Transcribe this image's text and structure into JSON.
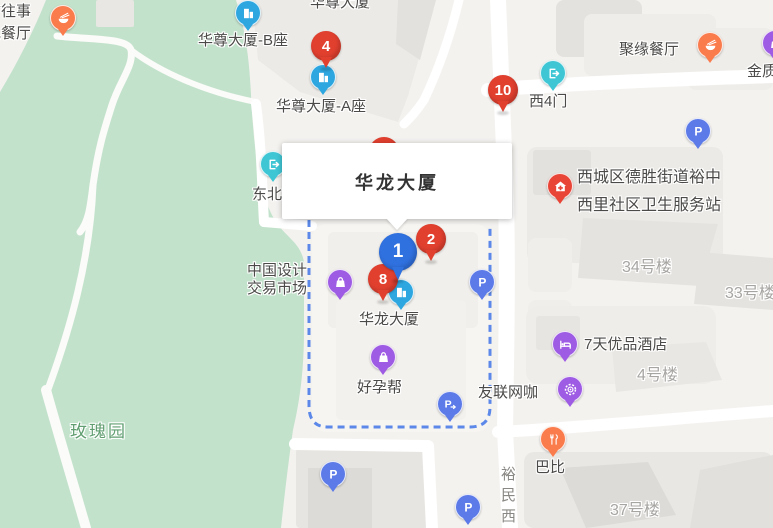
{
  "popup": {
    "title": "华龙大厦"
  },
  "colors": {
    "marker_red": "#e2402f",
    "marker_blue": "#3071e0",
    "poi_blue": "#2ea7e0",
    "poi_cyan": "#3fc6d5",
    "poi_purple": "#9e5be4",
    "poi_orange": "#fa7b4c",
    "poi_red": "#e84537",
    "parking_blue": "#5c7be8",
    "boundary_blue": "#4a7ce8",
    "park_green": "#c3e2cc",
    "label_dark": "#4b4a48",
    "label_gray": "#a7a5a2",
    "label_green": "#609e71"
  },
  "map": {
    "labels": [
      {
        "id": "guwangshi-restaurant",
        "lines": [
          "古往事",
          "色餐厅"
        ],
        "x": -14,
        "y": 1,
        "kind": "dark",
        "lh": 22
      },
      {
        "id": "huazun-tower",
        "lines": [
          "华尊大厦"
        ],
        "x": 310,
        "y": -7,
        "kind": "dark"
      },
      {
        "id": "huazun-tower-b",
        "lines": [
          "华尊大厦-B座"
        ],
        "x": 198,
        "y": 31,
        "kind": "dark"
      },
      {
        "id": "huazun-tower-a",
        "lines": [
          "华尊大厦-A座"
        ],
        "x": 276,
        "y": 97,
        "kind": "dark"
      },
      {
        "id": "juyuan-restaurant",
        "lines": [
          "聚缘餐厅"
        ],
        "x": 619,
        "y": 40,
        "kind": "dark"
      },
      {
        "id": "jinzhi",
        "lines": [
          "金质"
        ],
        "x": 747,
        "y": 62,
        "kind": "dark"
      },
      {
        "id": "west-gate-4",
        "lines": [
          "西4门"
        ],
        "x": 529,
        "y": 92,
        "kind": "dark"
      },
      {
        "id": "northeast-gate",
        "lines": [
          "东北门"
        ],
        "x": 252,
        "y": 185,
        "kind": "dark"
      },
      {
        "id": "health-service-station",
        "lines": [
          "西城区德胜街道裕中",
          "西里社区卫生服务站"
        ],
        "x": 577,
        "y": 164,
        "kind": "dark",
        "size": 16,
        "lh": 28
      },
      {
        "id": "building-34",
        "lines": [
          "34号楼"
        ],
        "x": 622,
        "y": 258,
        "kind": "area"
      },
      {
        "id": "building-33",
        "lines": [
          "33号楼"
        ],
        "x": 725,
        "y": 284,
        "kind": "area"
      },
      {
        "id": "china-design-market",
        "lines": [
          "中国设计",
          "交易市场"
        ],
        "x": 247,
        "y": 262,
        "kind": "dark",
        "lh": 18
      },
      {
        "id": "hualong-building",
        "lines": [
          "华龙大厦"
        ],
        "x": 359,
        "y": 310,
        "kind": "dark"
      },
      {
        "id": "haoyunbang",
        "lines": [
          "好孕帮"
        ],
        "x": 357,
        "y": 378,
        "kind": "dark"
      },
      {
        "id": "7days-hotel",
        "lines": [
          "7天优品酒店"
        ],
        "x": 584,
        "y": 335,
        "kind": "dark"
      },
      {
        "id": "building-4",
        "lines": [
          "4号楼"
        ],
        "x": 637,
        "y": 366,
        "kind": "area"
      },
      {
        "id": "youlian-netcafe",
        "lines": [
          "友联网咖"
        ],
        "x": 478,
        "y": 383,
        "kind": "dark"
      },
      {
        "id": "babi",
        "lines": [
          "巴比"
        ],
        "x": 535,
        "y": 458,
        "kind": "dark"
      },
      {
        "id": "building-37",
        "lines": [
          "37号楼"
        ],
        "x": 610,
        "y": 501,
        "kind": "area"
      },
      {
        "id": "rose-garden",
        "lines": [
          "玫瑰园"
        ],
        "x": 70,
        "y": 422,
        "kind": "park"
      },
      {
        "id": "yumin-west-road",
        "lines": [
          "裕民西"
        ],
        "x": 498,
        "y": 466,
        "kind": "road",
        "vertical": true
      }
    ],
    "poi_markers": [
      {
        "id": "guwangshi-restaurant",
        "icon": "food-bowl",
        "color": "poi_orange",
        "x": 63,
        "y": 18
      },
      {
        "id": "huazun-b",
        "icon": "building",
        "color": "poi_blue",
        "x": 248,
        "y": 13
      },
      {
        "id": "huazun-a",
        "icon": "building",
        "color": "poi_blue",
        "x": 323,
        "y": 77
      },
      {
        "id": "west-gate-4",
        "icon": "exit-gate",
        "color": "poi_cyan",
        "x": 553,
        "y": 73
      },
      {
        "id": "juyuan-restaurant",
        "icon": "food-bowl",
        "color": "poi_orange",
        "x": 710,
        "y": 45
      },
      {
        "id": "jinzhi",
        "icon": "shopping-bag",
        "color": "poi_purple",
        "x": 775,
        "y": 43
      },
      {
        "id": "northeast-gate",
        "icon": "exit-gate",
        "color": "poi_cyan",
        "x": 273,
        "y": 164
      },
      {
        "id": "health-station",
        "icon": "clinic-house",
        "color": "poi_red",
        "x": 560,
        "y": 186
      },
      {
        "id": "china-design-market",
        "icon": "shopping-bag",
        "color": "poi_purple",
        "x": 340,
        "y": 282
      },
      {
        "id": "hualong-building",
        "icon": "building",
        "color": "poi_blue",
        "x": 401,
        "y": 292
      },
      {
        "id": "haoyunbang",
        "icon": "shopping-bag",
        "color": "poi_purple",
        "x": 383,
        "y": 357
      },
      {
        "id": "7days-hotel",
        "icon": "hotel-bed",
        "color": "poi_purple",
        "x": 565,
        "y": 344
      },
      {
        "id": "youlian-netcafe",
        "icon": "internet-cafe",
        "color": "poi_purple",
        "x": 570,
        "y": 389
      },
      {
        "id": "babi",
        "icon": "restaurant-fork",
        "color": "poi_orange",
        "x": 553,
        "y": 439
      }
    ],
    "parking_markers": [
      {
        "id": "parking-1",
        "icon": "parking",
        "x": 698,
        "y": 131
      },
      {
        "id": "parking-2",
        "icon": "parking",
        "x": 482,
        "y": 282
      },
      {
        "id": "parking-3",
        "icon": "parking",
        "x": 333,
        "y": 474
      },
      {
        "id": "parking-4",
        "icon": "parking",
        "x": 468,
        "y": 507
      },
      {
        "id": "parking-entrance",
        "icon": "parking-arrow",
        "x": 450,
        "y": 404
      }
    ],
    "numbered_markers": [
      {
        "id": "marker-4",
        "n": "4",
        "color": "marker_red",
        "x": 326,
        "y": 46,
        "r": 15
      },
      {
        "id": "marker-10",
        "n": "10",
        "color": "marker_red",
        "x": 503,
        "y": 90,
        "r": 15
      },
      {
        "id": "marker-2",
        "n": "2",
        "color": "marker_red",
        "x": 431,
        "y": 239,
        "r": 15
      },
      {
        "id": "marker-8",
        "n": "8",
        "color": "marker_red",
        "x": 383,
        "y": 279,
        "r": 15
      },
      {
        "id": "marker-1",
        "n": "1",
        "color": "marker_blue",
        "x": 398,
        "y": 252,
        "r": 19
      },
      {
        "id": "occluded-marker",
        "n": "",
        "color": "marker_red",
        "x": 384,
        "y": 152,
        "r": 15,
        "occluded": true
      }
    ]
  }
}
